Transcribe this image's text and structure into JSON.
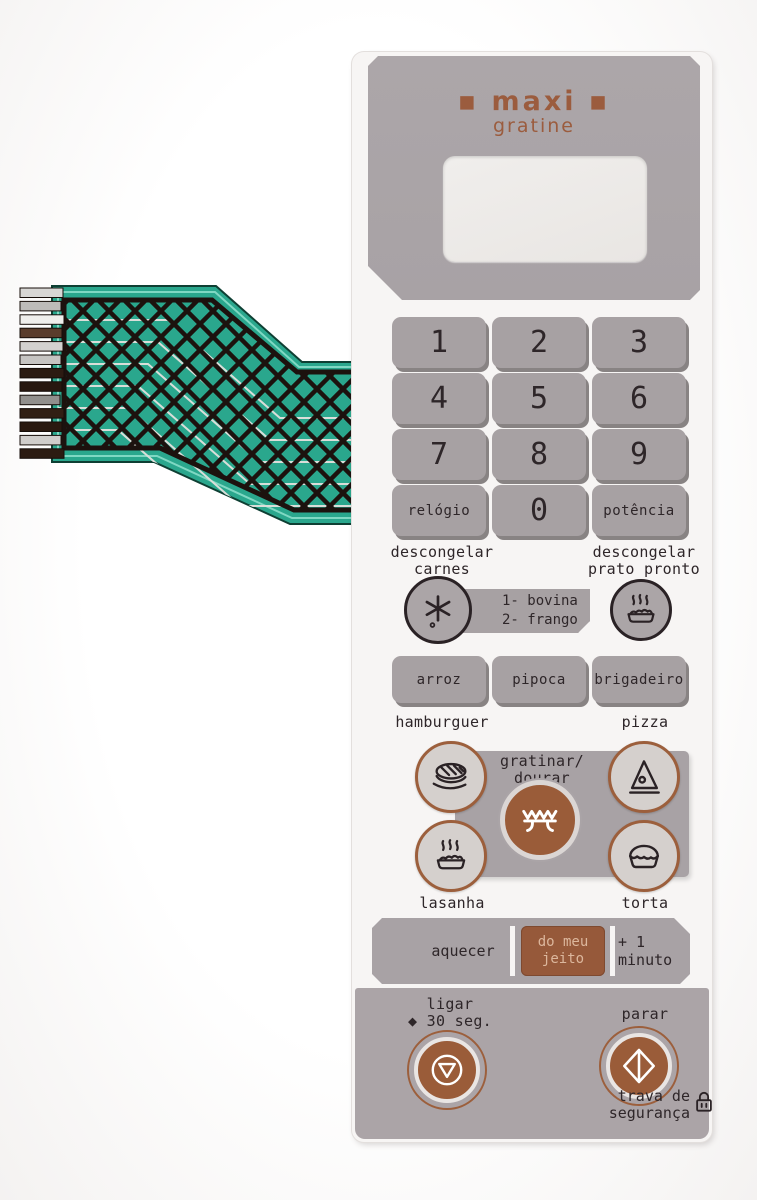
{
  "colors": {
    "accent_copper": "#9c5f3c",
    "panel_gray": "#a8a2a5",
    "button_brown": "#96593a",
    "cable_teal": "#2aa78d",
    "dark_ink": "#2e2629"
  },
  "brand": {
    "line1": "▪ maxi ▪",
    "line2": "gratine"
  },
  "display": {
    "value": ""
  },
  "keypad": {
    "keys": [
      "1",
      "2",
      "3",
      "4",
      "5",
      "6",
      "7",
      "8",
      "9",
      "relógio",
      "0",
      "potência"
    ]
  },
  "defrost": {
    "carnes_label": "descongelar\ncarnes",
    "prato_label": "descongelar\nprato pronto",
    "options": "1- bovina\n2- frango"
  },
  "foods": {
    "row": [
      "arroz",
      "pipoca",
      "brigadeiro"
    ]
  },
  "labels": {
    "hamburguer": "hamburguer",
    "pizza": "pizza",
    "lasanha": "lasanha",
    "torta": "torta"
  },
  "grill": {
    "label": "gratinar/\ndourar"
  },
  "heat": {
    "aquecer": "aquecer",
    "do_meu_jeito": "do meu\njeito",
    "plus_minute": "+ 1 minuto"
  },
  "controls": {
    "ligar": "ligar\n◆ 30 seg.",
    "parar": "parar",
    "trava": "trava de\nsegurança"
  }
}
